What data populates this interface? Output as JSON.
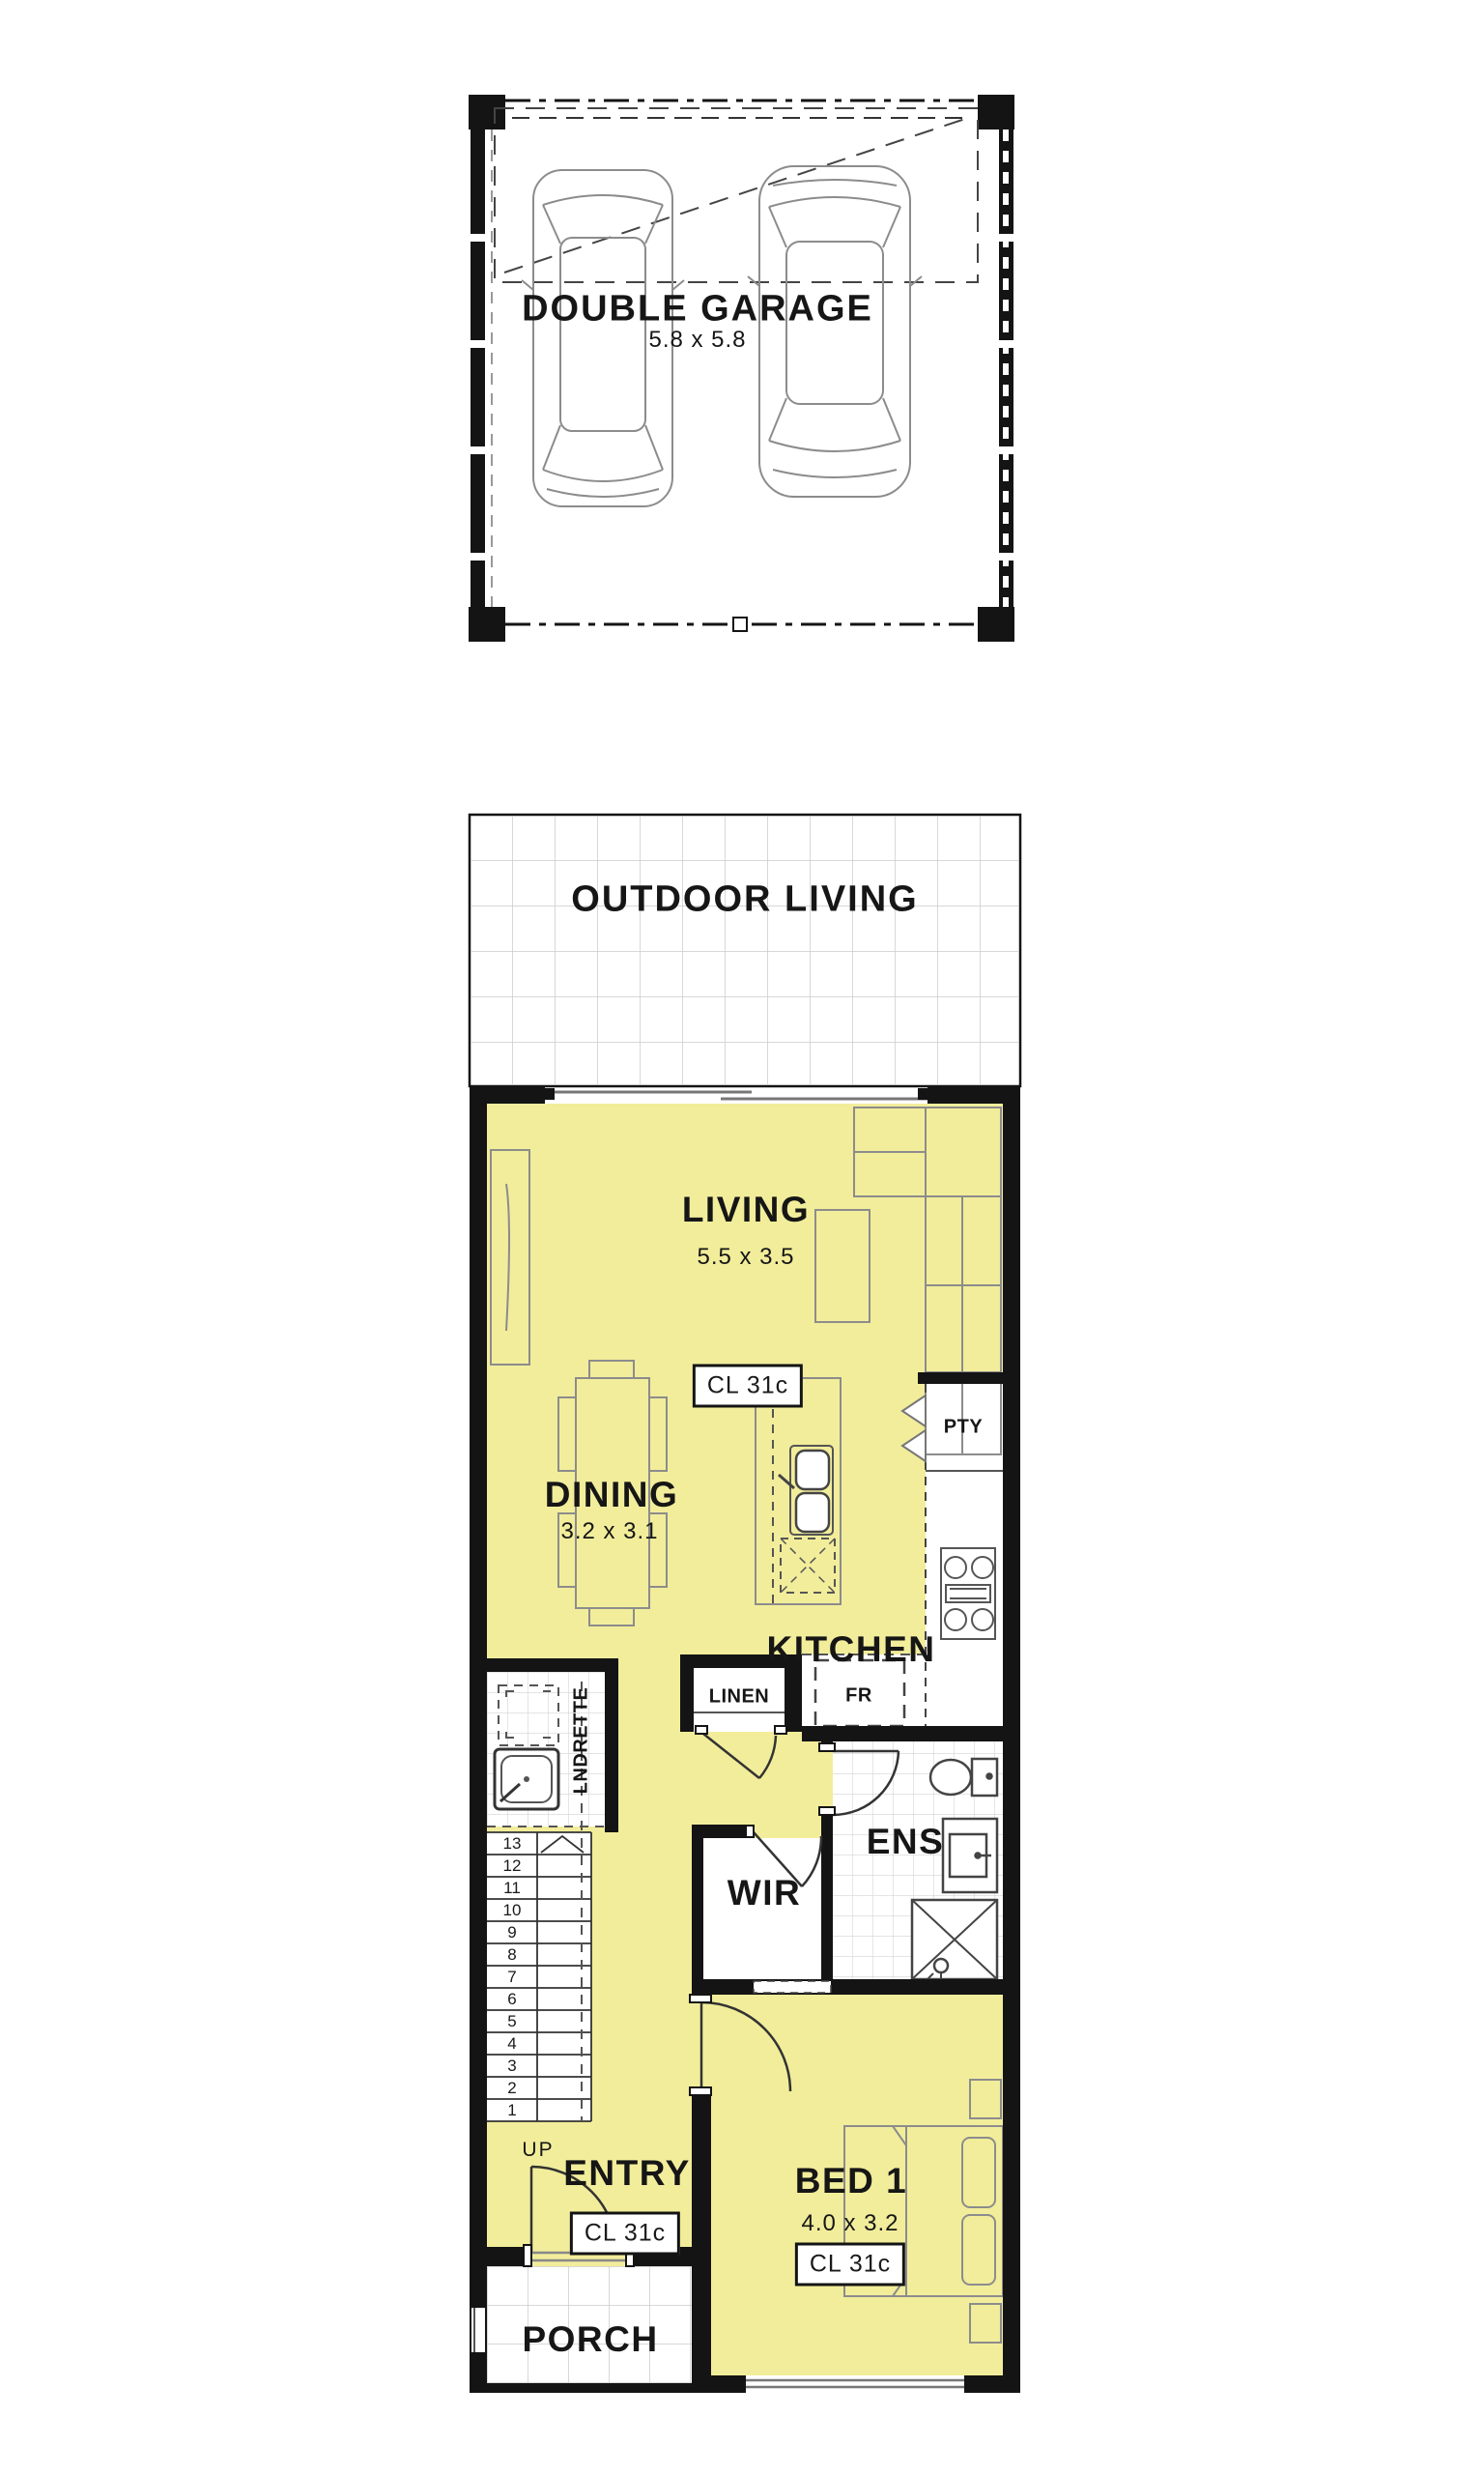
{
  "colors": {
    "room_fill": "#F2ED9B",
    "wall": "#141414",
    "tile_line": "#CCCCCC",
    "furniture_line": "#8C8C8C",
    "text": "#161616"
  },
  "plan": {
    "garage": {
      "label": "DOUBLE GARAGE",
      "dimensions": "5.8 x 5.8"
    },
    "outdoor_living": {
      "label": "OUTDOOR LIVING"
    },
    "living": {
      "label": "LIVING",
      "dimensions": "5.5 x 3.5",
      "ceiling_label": "CL 31c"
    },
    "dining": {
      "label": "DINING",
      "dimensions": "3.2 x 3.1"
    },
    "kitchen": {
      "label": "KITCHEN",
      "pantry": "PTY",
      "fridge": "FR",
      "linen": "LINEN"
    },
    "laundrette": {
      "label": "LNDRETTE"
    },
    "ensuite": {
      "label": "ENS"
    },
    "wir": {
      "label": "WIR"
    },
    "entry": {
      "label": "ENTRY",
      "up": "UP",
      "ceiling_label": "CL 31c"
    },
    "bed1": {
      "label": "BED 1",
      "dimensions": "4.0 x 3.2",
      "ceiling_label": "CL 31c"
    },
    "porch": {
      "label": "PORCH"
    },
    "stairs": {
      "numbers": [
        "13",
        "12",
        "11",
        "10",
        "9",
        "8",
        "7",
        "6",
        "5",
        "4",
        "3",
        "2",
        "1"
      ]
    }
  }
}
